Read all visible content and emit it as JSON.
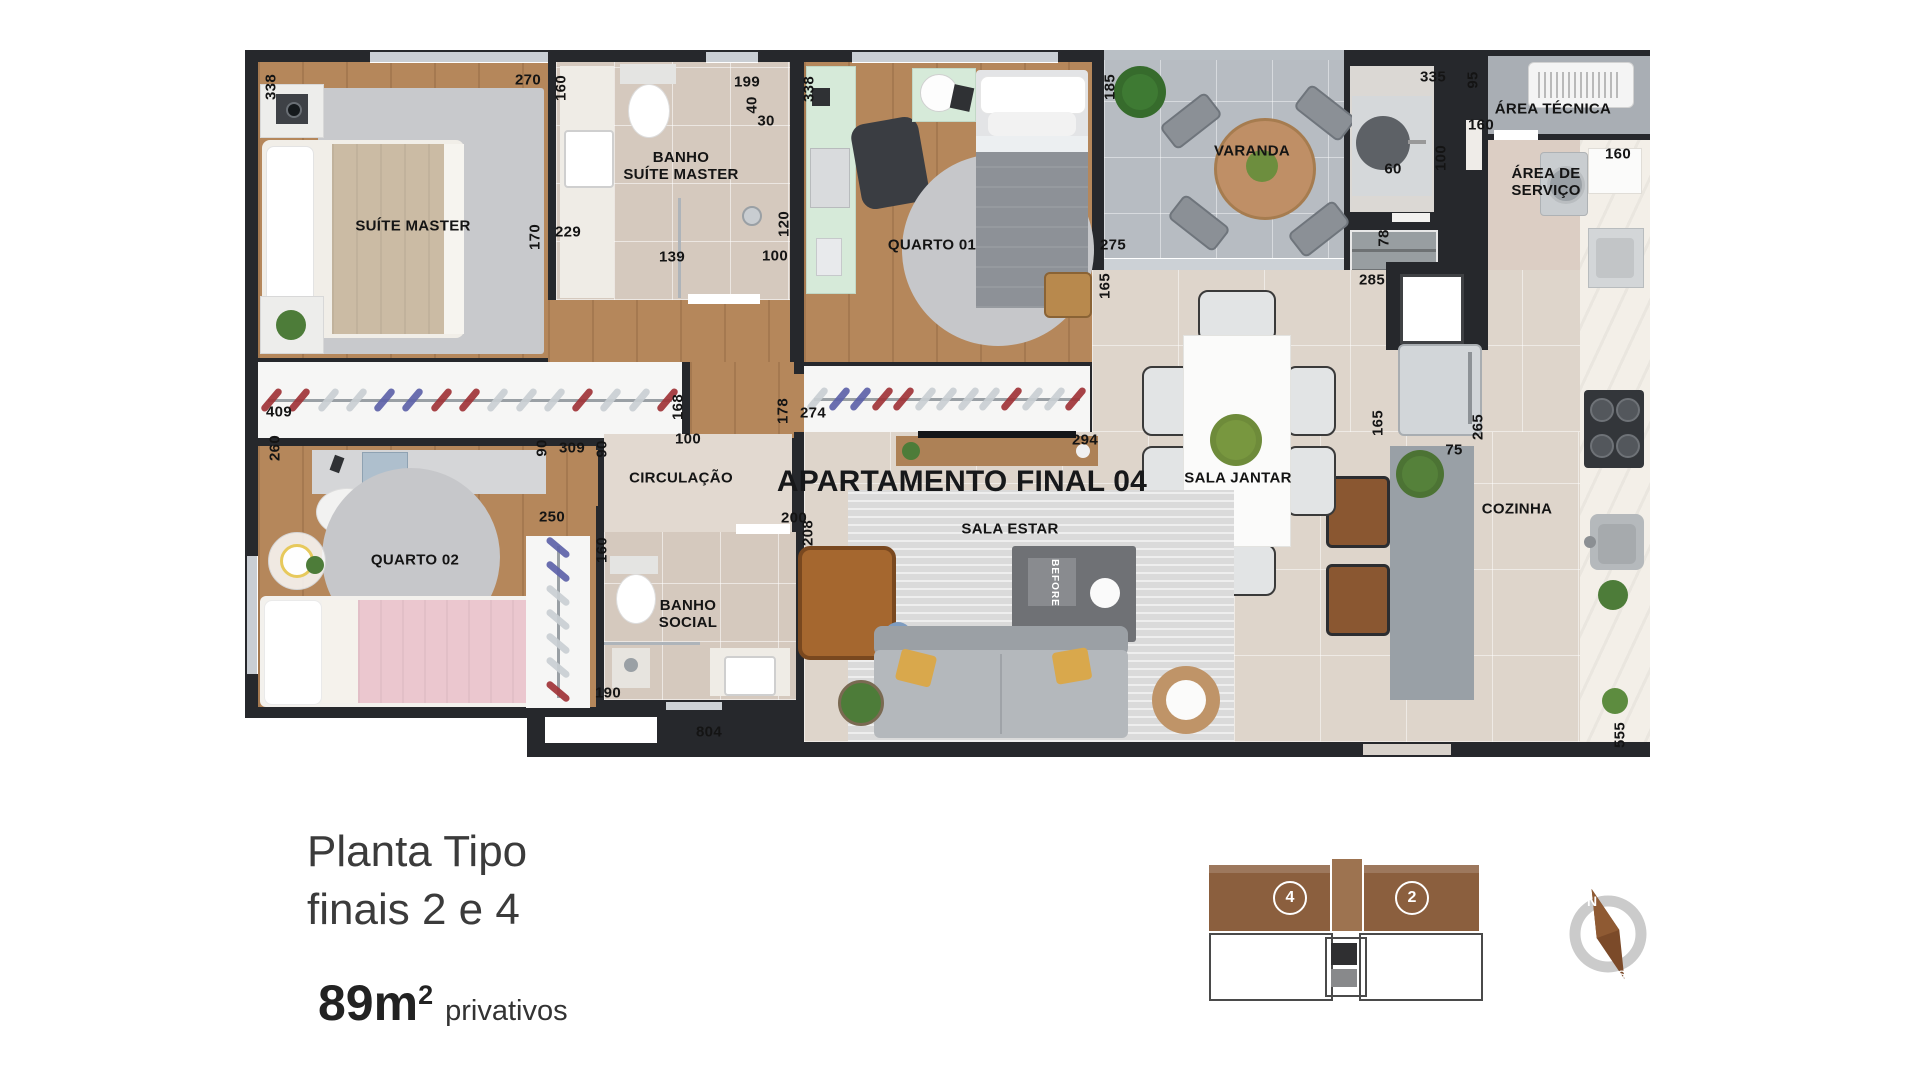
{
  "plan": {
    "title": "APARTAMENTO FINAL 04",
    "decor_book": "BEFORE",
    "room_labels": [
      {
        "text": "SUÍTE MASTER",
        "x": 413,
        "y": 227
      },
      {
        "text": "BANHO\nSUÍTE MASTER",
        "x": 681,
        "y": 167
      },
      {
        "text": "QUARTO 01",
        "x": 932,
        "y": 246
      },
      {
        "text": "VARANDA",
        "x": 1252,
        "y": 152
      },
      {
        "text": "ÁREA TÉCNICA",
        "x": 1553,
        "y": 110
      },
      {
        "text": "ÁREA DE\nSERVIÇO",
        "x": 1546,
        "y": 183
      },
      {
        "text": "CIRCULAÇÃO",
        "x": 681,
        "y": 479
      },
      {
        "text": "BANHO\nSOCIAL",
        "x": 688,
        "y": 615
      },
      {
        "text": "QUARTO 02",
        "x": 415,
        "y": 561
      },
      {
        "text": "SALA ESTAR",
        "x": 1010,
        "y": 530
      },
      {
        "text": "SALA JANTAR",
        "x": 1238,
        "y": 479
      },
      {
        "text": "COZINHA",
        "x": 1517,
        "y": 510
      }
    ],
    "dimensions": [
      {
        "t": "338",
        "x": 272,
        "y": 87,
        "v": true
      },
      {
        "t": "270",
        "x": 528,
        "y": 81
      },
      {
        "t": "160",
        "x": 562,
        "y": 88,
        "v": true
      },
      {
        "t": "199",
        "x": 747,
        "y": 83
      },
      {
        "t": "40",
        "x": 753,
        "y": 105,
        "v": true
      },
      {
        "t": "30",
        "x": 766,
        "y": 122
      },
      {
        "t": "338",
        "x": 810,
        "y": 89,
        "v": true
      },
      {
        "t": "185",
        "x": 1111,
        "y": 87,
        "v": true
      },
      {
        "t": "335",
        "x": 1433,
        "y": 78
      },
      {
        "t": "95",
        "x": 1474,
        "y": 80,
        "v": true
      },
      {
        "t": "160",
        "x": 1481,
        "y": 126
      },
      {
        "t": "60",
        "x": 1393,
        "y": 170
      },
      {
        "t": "100",
        "x": 1442,
        "y": 158,
        "v": true
      },
      {
        "t": "160",
        "x": 1618,
        "y": 155
      },
      {
        "t": "229",
        "x": 568,
        "y": 233
      },
      {
        "t": "170",
        "x": 536,
        "y": 237,
        "v": true
      },
      {
        "t": "120",
        "x": 785,
        "y": 224,
        "v": true
      },
      {
        "t": "139",
        "x": 672,
        "y": 258
      },
      {
        "t": "100",
        "x": 775,
        "y": 257
      },
      {
        "t": "275",
        "x": 1113,
        "y": 246
      },
      {
        "t": "165",
        "x": 1106,
        "y": 286,
        "v": true
      },
      {
        "t": "78",
        "x": 1385,
        "y": 238,
        "v": true
      },
      {
        "t": "285",
        "x": 1372,
        "y": 281
      },
      {
        "t": "409",
        "x": 279,
        "y": 413
      },
      {
        "t": "168",
        "x": 679,
        "y": 407,
        "v": true
      },
      {
        "t": "178",
        "x": 784,
        "y": 411,
        "v": true
      },
      {
        "t": "274",
        "x": 813,
        "y": 414
      },
      {
        "t": "294",
        "x": 1085,
        "y": 441
      },
      {
        "t": "260",
        "x": 276,
        "y": 448,
        "v": true
      },
      {
        "t": "90",
        "x": 543,
        "y": 448,
        "v": true
      },
      {
        "t": "309",
        "x": 572,
        "y": 449
      },
      {
        "t": "90",
        "x": 603,
        "y": 449,
        "v": true
      },
      {
        "t": "100",
        "x": 688,
        "y": 440
      },
      {
        "t": "250",
        "x": 552,
        "y": 518
      },
      {
        "t": "200",
        "x": 794,
        "y": 519
      },
      {
        "t": "208",
        "x": 809,
        "y": 533,
        "v": true
      },
      {
        "t": "160",
        "x": 603,
        "y": 550,
        "v": true
      },
      {
        "t": "165",
        "x": 1379,
        "y": 423,
        "v": true
      },
      {
        "t": "265",
        "x": 1479,
        "y": 427,
        "v": true
      },
      {
        "t": "75",
        "x": 1454,
        "y": 451
      },
      {
        "t": "190",
        "x": 608,
        "y": 694
      },
      {
        "t": "804",
        "x": 709,
        "y": 733
      },
      {
        "t": "555",
        "x": 1621,
        "y": 735,
        "v": true
      }
    ]
  },
  "caption": {
    "line1": "Planta Tipo",
    "line2": "finais 2 e 4",
    "area_number": "89m",
    "area_sup": "2",
    "area_suffix": "privativos"
  },
  "keyplan": {
    "units": [
      {
        "label": "4"
      },
      {
        "label": "2"
      }
    ]
  },
  "compass": {
    "north": "N",
    "south": "S"
  }
}
